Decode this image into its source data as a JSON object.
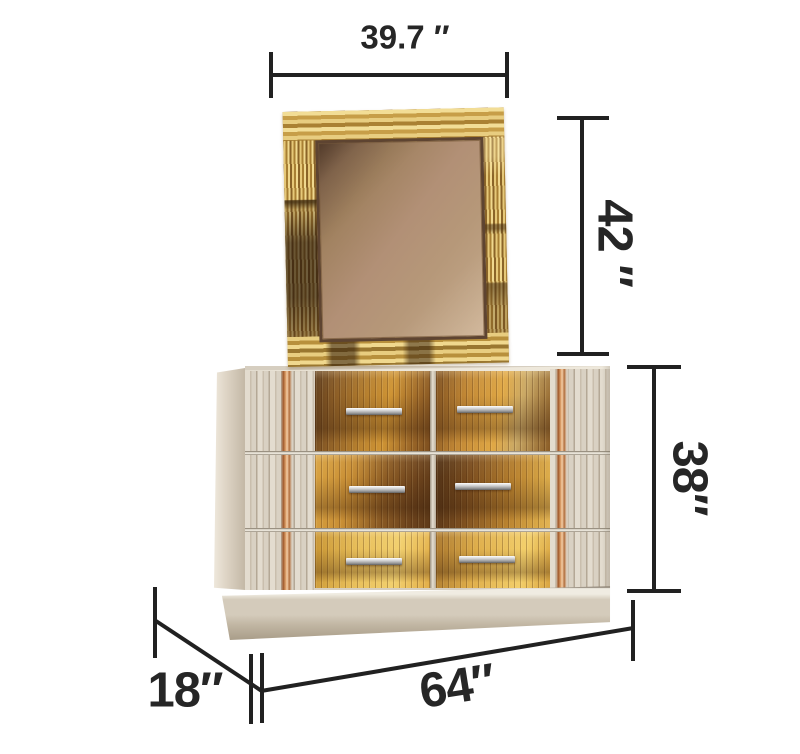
{
  "figure": {
    "alt": "Dimension diagram of a gold mirrored dresser with matching mirror",
    "background": "#ffffff"
  },
  "dimensions": {
    "mirror_width": "39.7 ″",
    "mirror_height": "42 ″",
    "dresser_height": "38″",
    "dresser_width": "64″",
    "dresser_depth": "18″"
  },
  "colors": {
    "dimension_line": "#212121",
    "label_text": "#262626",
    "mirror_frame_gold": "#c9a24a",
    "mirror_glass_bronze": "#b09074",
    "dresser_body_cream": "#d6cec0",
    "drawer_mirror_gold": "#c9913a",
    "handle_silver": "#cfcfcf",
    "accent_copper": "#b5713f"
  }
}
